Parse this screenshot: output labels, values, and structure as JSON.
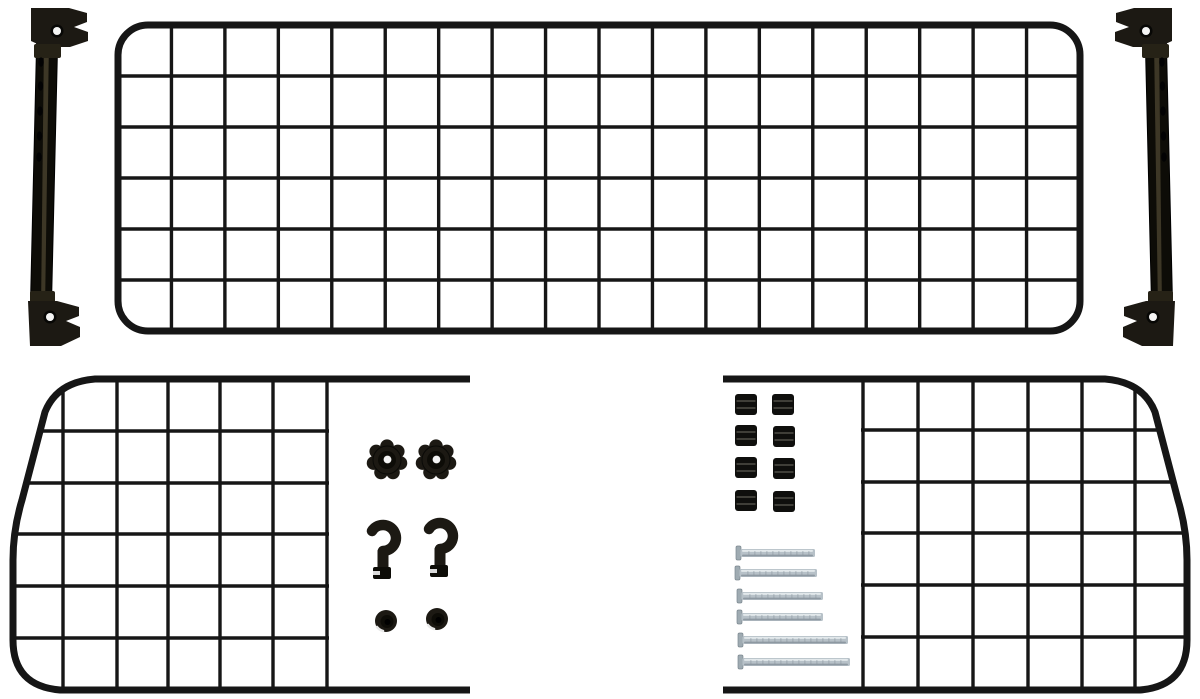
{
  "canvas": {
    "width": 1200,
    "height": 699,
    "background": "#ffffff"
  },
  "colors": {
    "wire": "#161616",
    "plastic": "#1c1913",
    "plastic_mid": "#262216",
    "plastic_dark": "#0d0c07",
    "streak": "#46402c",
    "rib": "#45443d",
    "metal": "#b7c1c8",
    "metal_light": "#e4eaed",
    "metal_dark": "#8a959d",
    "metal_head": "#9fabb2",
    "hole_white": "#f4f4f4"
  },
  "parts": {
    "main_mesh_panel": {
      "x": 118,
      "y": 25,
      "width": 962,
      "height": 306,
      "corner_radius": 30,
      "columns": 18,
      "rows": 6,
      "frame_stroke": 7,
      "wire_stroke": 3.4
    },
    "left_mounting_bar": {
      "pole_points": "37,27 58,27 51,324 30,324",
      "streak_points": "44,40 49,40 45,310 41,310",
      "top_clamp_path": "M31,8 L69,8 L87,13 L87,22 L74,27 L88,32 L88,41 L70,47 L44,47 L31,41 Z",
      "top_sleeve": {
        "x": 34,
        "y": 44,
        "w": 27,
        "h": 14
      },
      "bottom_sleeve": {
        "x": 30,
        "y": 291,
        "w": 25,
        "h": 14
      },
      "bottom_clamp_path": "M28,301 L57,301 L79,307 L79,316 L66,321 L80,327 L80,337 L61,346 L30,346 Z",
      "top_screw": {
        "cx": 57,
        "cy": 31
      },
      "bottom_screw": {
        "cx": 50,
        "cy": 317
      },
      "holes": [
        [
          41,
          62
        ],
        [
          40.5,
          86
        ],
        [
          40,
          111
        ],
        [
          39.5,
          136
        ],
        [
          39,
          157
        ]
      ]
    },
    "right_mounting_bar": {
      "transform": "translate(1203,0) scale(-1,1)"
    },
    "left_side_panel": {
      "outline": "M 470,379 L 95,379 Q 57,382 45,412 L 22,500 Q 13,530 13,560 L 13,640 Q 13,686 60,690 L 470,690",
      "frame_stroke": 7,
      "wire_stroke": 3.4,
      "mesh_verticals": [
        63,
        117,
        168,
        220,
        273,
        327
      ],
      "mesh_horizontals": [
        431,
        483,
        534,
        586,
        638
      ],
      "v_span": [
        376,
        693
      ],
      "h_span": [
        10,
        329
      ]
    },
    "right_side_panel": {
      "outline": "M 723,379 L 1105,379 Q 1143,382 1155,412 L 1178,500 Q 1187,530 1187,560 L 1187,640 Q 1187,686 1140,690 L 723,690",
      "frame_stroke": 7,
      "wire_stroke": 3.4,
      "mesh_verticals": [
        863,
        918,
        973,
        1028,
        1082,
        1135
      ],
      "mesh_horizontals": [
        430,
        482,
        533,
        585,
        637
      ],
      "v_span": [
        376,
        693
      ],
      "h_span": [
        861,
        1192
      ]
    },
    "hardware": {
      "star_knobs": {
        "count": 2,
        "outer_radius": 20,
        "lobes": 7,
        "centers": [
          [
            387,
            460
          ],
          [
            436,
            460
          ]
        ]
      },
      "hooks": {
        "count": 2,
        "centers": [
          [
            383,
            551
          ],
          [
            440,
            549
          ]
        ]
      },
      "end_caps": {
        "count": 2,
        "radius": 11,
        "centers": [
          [
            386,
            621
          ],
          [
            437,
            619
          ]
        ]
      },
      "spacers": {
        "count": 8,
        "width": 22,
        "height": 21,
        "positions": [
          [
            735,
            394
          ],
          [
            772,
            394
          ],
          [
            735,
            425
          ],
          [
            773,
            426
          ],
          [
            735,
            457
          ],
          [
            773,
            458
          ],
          [
            735,
            490
          ],
          [
            773,
            491
          ]
        ]
      },
      "screws": {
        "count": 6,
        "shaft_height": 8,
        "items": [
          {
            "x": 736,
            "y": 549,
            "length": 79
          },
          {
            "x": 735,
            "y": 569,
            "length": 82
          },
          {
            "x": 737,
            "y": 592,
            "length": 86
          },
          {
            "x": 737,
            "y": 613,
            "length": 86
          },
          {
            "x": 738,
            "y": 636,
            "length": 110
          },
          {
            "x": 738,
            "y": 658,
            "length": 112
          }
        ]
      }
    }
  }
}
